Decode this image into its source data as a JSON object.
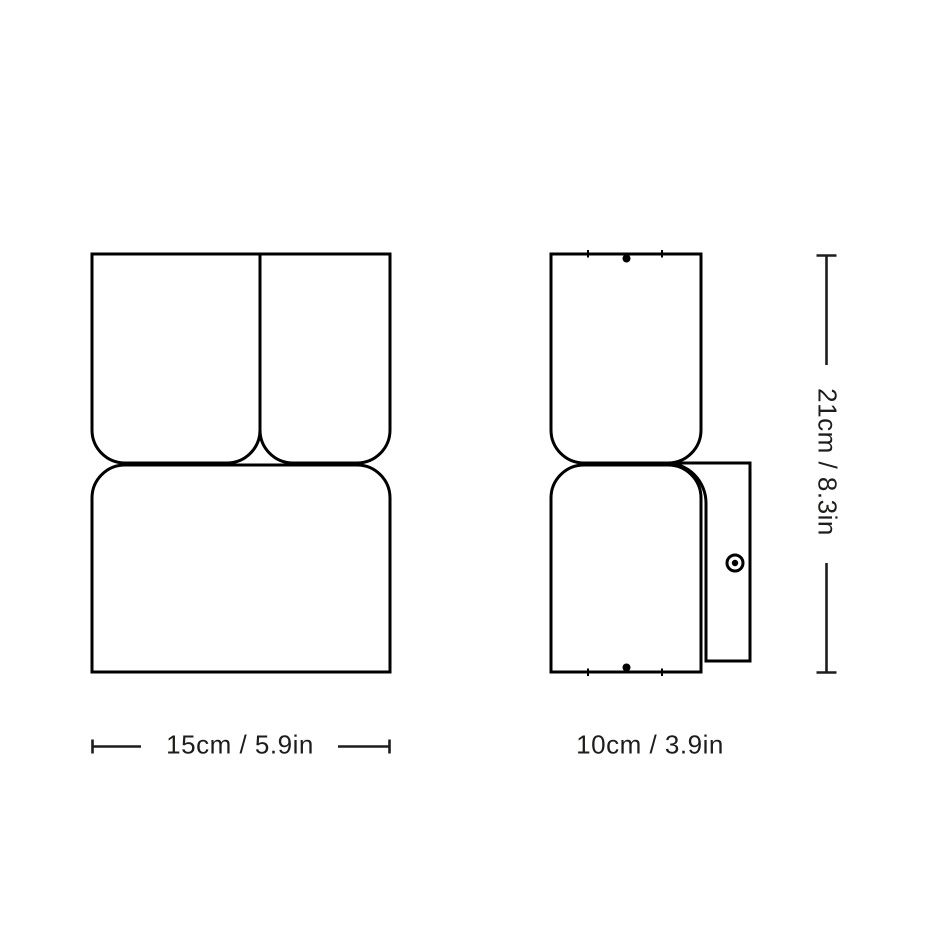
{
  "diagram": {
    "type": "product-dimension-drawing",
    "views": {
      "front_view": "front",
      "side_view": "side"
    },
    "dimensions": {
      "width": {
        "label": "15cm / 5.9in"
      },
      "depth": {
        "label": "10cm / 3.9in"
      },
      "height": {
        "label": "21cm / 8.3in"
      }
    },
    "colors": {
      "line": "#000000",
      "text": "#1d1d1b",
      "background": "#ffffff"
    }
  }
}
